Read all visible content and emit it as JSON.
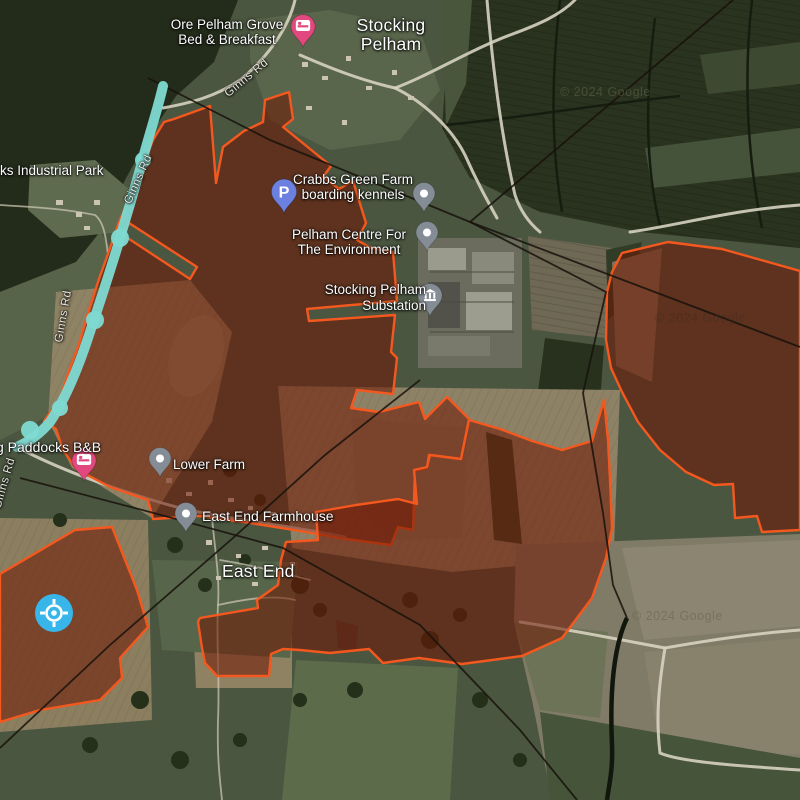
{
  "app": {
    "name": "satellite-map-view"
  },
  "attribution": "© 2024 Google",
  "theme": {
    "overlay_stroke": "#f4581e",
    "overlay_fill": "rgba(112,22,2,0.55)",
    "route_color": "#7edad2",
    "pin_pink": "#e1487d",
    "pin_blue": "#6c80e0",
    "pin_gray": "#848d96",
    "location_blue": "#38b6ea",
    "label_color": "#ffffff"
  },
  "labels": {
    "ore_pelham_bnb": {
      "line1": "Ore Pelham Grove",
      "line2": "Bed & Breakfast"
    },
    "stocking_pelham_town": {
      "line1": "Stocking",
      "line2": "Pelham"
    },
    "ginns_rd": "Ginns Rd",
    "industrial_park": "ks Industrial Park",
    "crabbs_green": {
      "line1": "Crabbs Green Farm",
      "line2": "boarding kennels"
    },
    "pelham_centre": {
      "line1": "Pelham Centre For",
      "line2": "The Environment"
    },
    "substation": {
      "line1": "Stocking Pelham",
      "line2": "Substation"
    },
    "paddocks_bnb": "g Paddocks B&B",
    "lower_farm": "Lower Farm",
    "east_end_farmhouse": "East End Farmhouse",
    "east_end_town": "East End",
    "parking_glyph": "P"
  },
  "icons": {
    "bed_pins": "bed-icon",
    "parking_pin": "parking-icon",
    "generic_pins": "poi-dot-icon",
    "substation_pin": "bank-building-icon",
    "location_marker": "compass-crosshair-icon"
  }
}
